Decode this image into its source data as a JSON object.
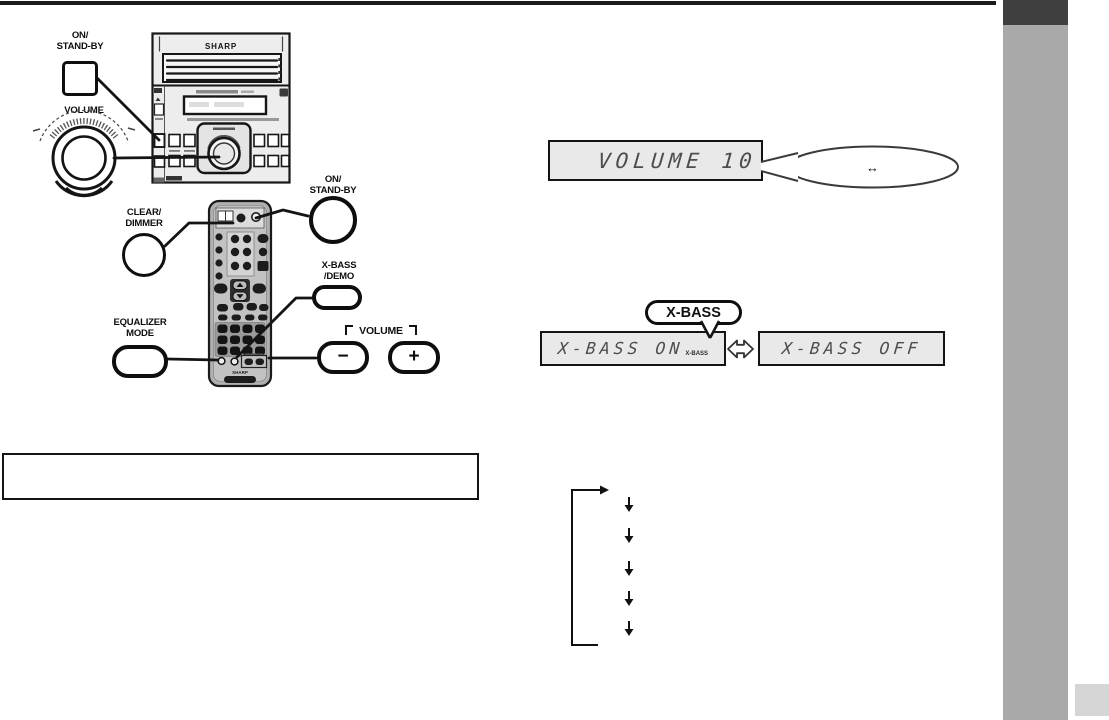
{
  "colors": {
    "top_rule": "#1a1a1a",
    "sidebar_tab": "#3f3f3f",
    "sidebar_bar": "#a9a9a9",
    "corner_square": "#d6d6d6",
    "display_bg": "#e9e9e9",
    "ink": "#111111"
  },
  "labels": {
    "on_standby_main": {
      "line1": "ON/",
      "line2": "STAND-BY"
    },
    "volume_main": "VOLUME",
    "clear_dimmer": {
      "line1": "CLEAR/",
      "line2": "DIMMER"
    },
    "on_standby_remote": {
      "line1": "ON/",
      "line2": "STAND-BY"
    },
    "x_bass_demo": {
      "line1": "X-BASS",
      "line2": "/DEMO"
    },
    "equalizer_mode": {
      "line1": "EQUALIZER",
      "line2": "MODE"
    },
    "volume_group": "VOLUME",
    "volume_minus": "−",
    "volume_plus": "+"
  },
  "device": {
    "unit_brand": "SHARP",
    "remote_brand": "SHARP"
  },
  "displays": {
    "volume_text": "VOLUME 10",
    "volume_callout_symbol": "↔",
    "x_bass_button": "X-BASS",
    "x_bass_on": "X-BASS ON",
    "x_bass_on_indicator": "X-BASS",
    "x_bass_off": "X-BASS OFF"
  },
  "note_box_text": ""
}
